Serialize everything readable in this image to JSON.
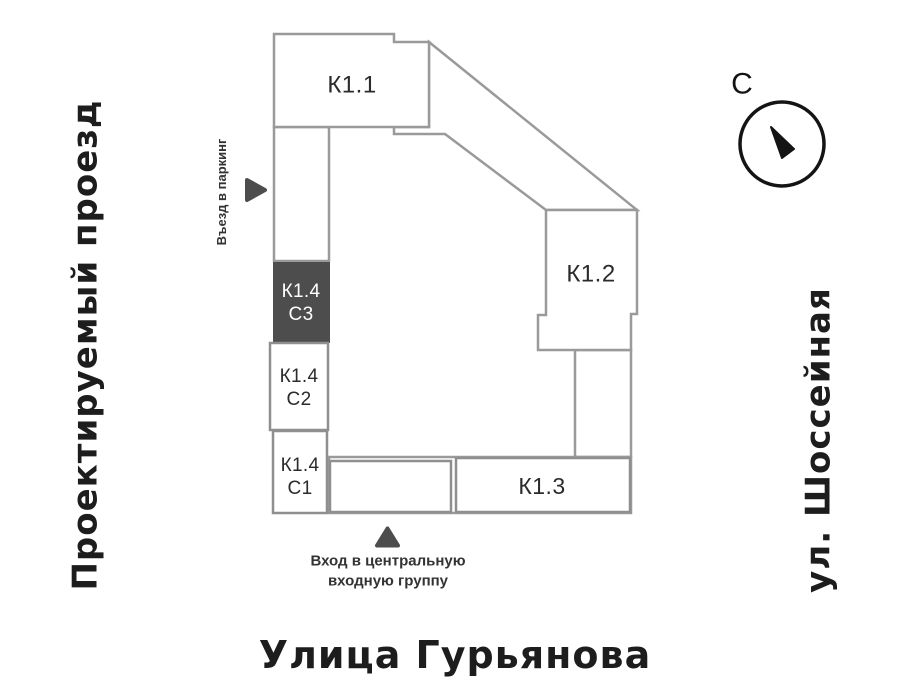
{
  "streets": {
    "left": "Проектируемый проезд",
    "right": "ул. Шоссейная",
    "bottom": "Улица Гурьянова"
  },
  "compass": {
    "north_label": "С"
  },
  "notes": {
    "parking": "Въезд в паркинг",
    "entrance": "Вход в центральную\nвходную группу"
  },
  "buildings": {
    "k11": {
      "label": "К1.1"
    },
    "k12": {
      "label": "К1.2"
    },
    "k13": {
      "label": "К1.3"
    },
    "k14c3": {
      "label": "К1.4\nС3",
      "selected": true
    },
    "k14c2": {
      "label": "К1.4\nС2",
      "selected": false
    },
    "k14c1": {
      "label": "К1.4\nС1",
      "selected": false
    }
  },
  "colors": {
    "outline": "#9A9A9A",
    "section_border": "#8F8F8F",
    "highlight_fill": "#4D4D4D",
    "marker": "#4D4D4D",
    "block_label": "#2B2B2B",
    "street_label": "#1D1D1D",
    "compass": "#141414"
  }
}
